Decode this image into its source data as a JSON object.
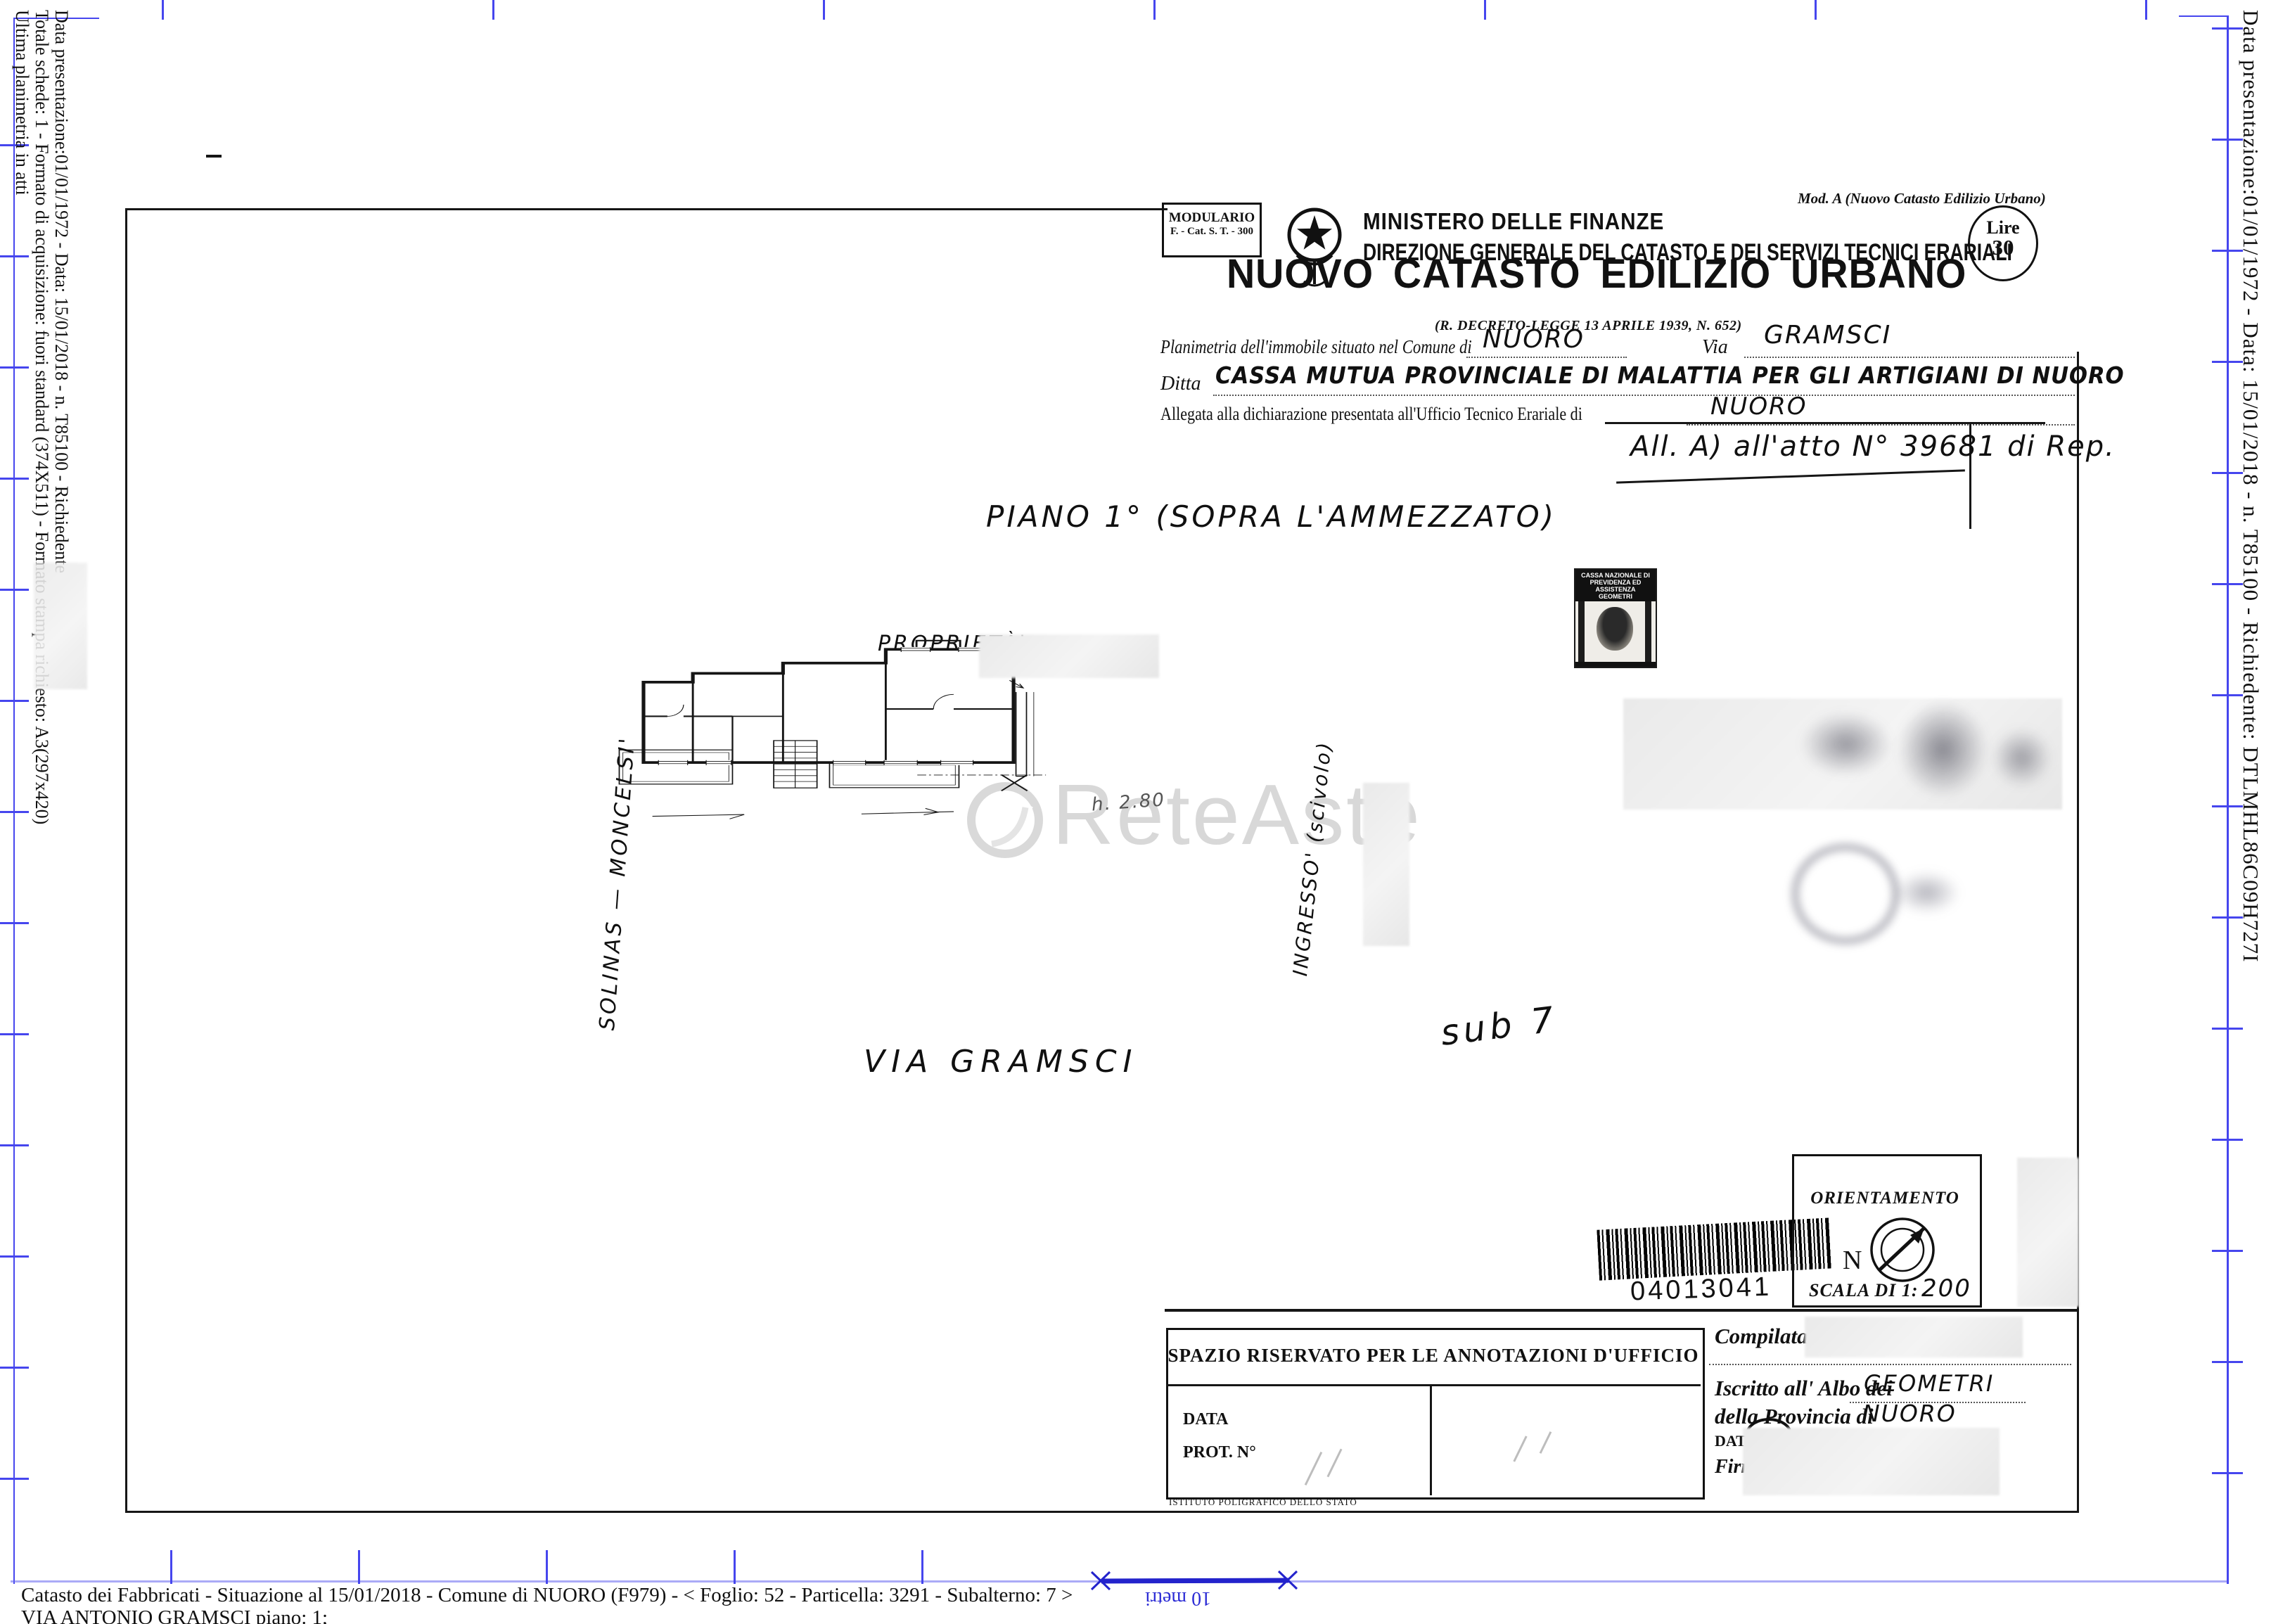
{
  "edges": {
    "left": [
      "Data presentazione:01/01/1972 - Data: 15/01/2018 - n. T85100 - Richiedente",
      "Totale schede: 1 - Formato di acquisizione: fuori standard (374X511) - Formato stampa richiesto: A3(297x420)",
      "Ultima planimetria in atti"
    ],
    "right": "Data presentazione:01/01/1972 - Data: 15/01/2018 - n. T85100 - Richiedente: DTLMHL86C09H727I"
  },
  "bottom_bar": {
    "line1": "Catasto dei Fabbricati - Situazione al 15/01/2018 - Comune di NUORO (F979) - <  Foglio: 52 - Particella: 3291 - Subalterno: 7 >",
    "line2": "VIA ANTONIO GRAMSCI piano: 1;",
    "scale_label": "10 metri"
  },
  "header": {
    "modulario_line1": "MODULARIO",
    "modulario_line2": "F. - Cat. S. T. - 300",
    "mod_a": "Mod. A (Nuovo Catasto Edilizio Urbano)",
    "ministero": "MINISTERO DELLE FINANZE",
    "direzione": "DIREZIONE GENERALE DEL CATASTO E DEI SERVIZI TECNICI ERARIALI",
    "lire_label": "Lire",
    "lire_value": "30",
    "title": "NUOVO CATASTO EDILIZIO URBANO",
    "decreto": "(R. DECRETO-LEGGE 13 APRILE 1939, N. 652)",
    "planimetria_label": "Planimetria dell'immobile situato nel Comune di",
    "comune_value": "NUORO",
    "via_label": "Via",
    "via_value": "GRAMSCI",
    "ditta_label": "Ditta",
    "ditta_value": "CASSA MUTUA PROVINCIALE DI MALATTIA PER GLI ARTIGIANI DI NUORO",
    "allegata_label": "Allegata alla dichiarazione presentata all'Ufficio Tecnico Erariale di",
    "allegata_value": "NUORO",
    "atto_note": "All. A) all'atto N° 39681 di Rep."
  },
  "plan": {
    "piano_note": "PIANO  1°  (SOPRA L'AMMEZZATO)",
    "proprieta_label": "PROPRIETÀ'",
    "owner_side_label": "SOLINAS — MONCELSI'",
    "ingresso_label": "INGRESSO'  (scivolo)",
    "street_label": "VIA  GRAMSCI",
    "sub_note": "sub 7",
    "height_note": "h. 2.80",
    "watermark": "ReteAste"
  },
  "stamp": {
    "line1": "CASSA NAZIONALE DI",
    "line2": "PREVIDENZA ED ASSISTENZA",
    "line3": "GEOMETRI"
  },
  "footer_boxes": {
    "barcode_number": "04013041",
    "orientamento_title": "ORIENTAMENTO",
    "north_label": "N",
    "scala_label": "SCALA DI 1:",
    "scala_value": "200",
    "annotazioni_title": "SPAZIO RISERVATO PER LE ANNOTAZIONI D'UFFICIO",
    "data_label": "DATA",
    "prot_label": "PROT. N°",
    "poligrafico": "ISTITUTO POLIGRAFICO DELLO STATO",
    "compilata_label": "Compilata dal",
    "iscritto_label": "Iscritto all' Albo dei",
    "iscritto_value": "GEOMETRI",
    "provincia_label": "della Provincia di",
    "provincia_value": "NUORO",
    "data2_label": "DATA",
    "firma_label": "Firma"
  },
  "colors": {
    "crop_blue": "#4646ee",
    "scale_blue": "#2323cc",
    "ink": "#111111"
  }
}
